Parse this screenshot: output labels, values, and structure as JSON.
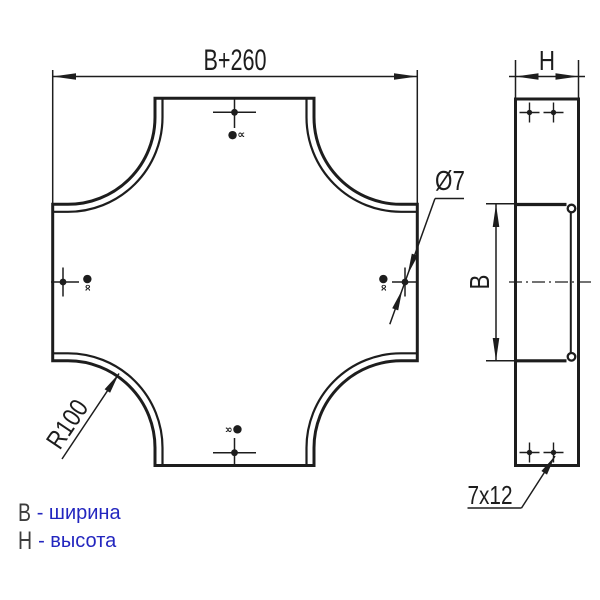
{
  "drawing": {
    "line_color": "#1d1d1d",
    "front_view": {
      "width_dim": "B+260",
      "radius_label": "R100",
      "hole_label": "Ø7",
      "hole_mark": "●∝"
    },
    "side_view": {
      "height_dim": "H",
      "width_dim": "B",
      "slot_label": "7x12"
    },
    "legend": {
      "text_color": "#2326bf",
      "letter_color": "#3d3d3d",
      "items": [
        {
          "symbol": "B",
          "meaning": "- ширина"
        },
        {
          "symbol": "H",
          "meaning": "- высота"
        }
      ]
    }
  }
}
